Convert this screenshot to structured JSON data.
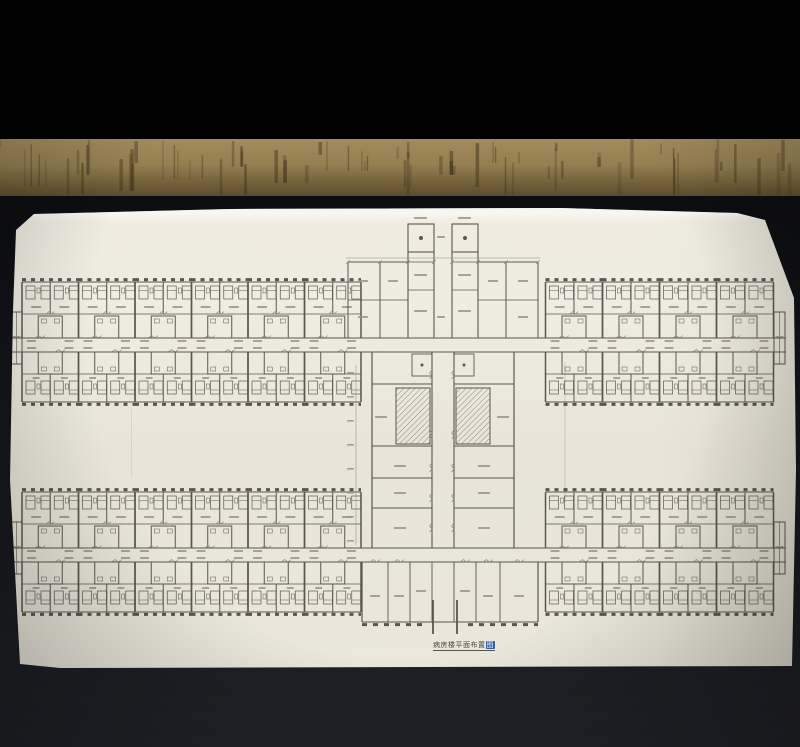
{
  "scene": {
    "letterbox_color": "#000000",
    "wood_surface": {
      "base": "#937f51",
      "light": "#a38c5c",
      "shadow": "#5d4c2c",
      "streak": "#3a2d14"
    },
    "table_edge_color": "#17130e",
    "backdrop_top": "#0c0d10",
    "backdrop_bottom": "#212329",
    "paper_color": "#efece1",
    "paper_highlight": "#f8f8f1"
  },
  "plan": {
    "type": "floorplan",
    "subject": "ward-building-floor-plan",
    "ink": "#46433b",
    "ink_light": "#807b6d",
    "label_color": "#8f8a7b",
    "title": {
      "main": "病房楼平面布置",
      "stamp": "图",
      "stamp_color": "#2f5fa8"
    },
    "wings": {
      "rows": 2,
      "left_module_count": 6,
      "right_module_count": 4,
      "rooms_per_module_side": 2,
      "beds_per_room": 2
    },
    "core": {
      "stair_shafts": 2,
      "has_hatched_stairs": true
    }
  }
}
